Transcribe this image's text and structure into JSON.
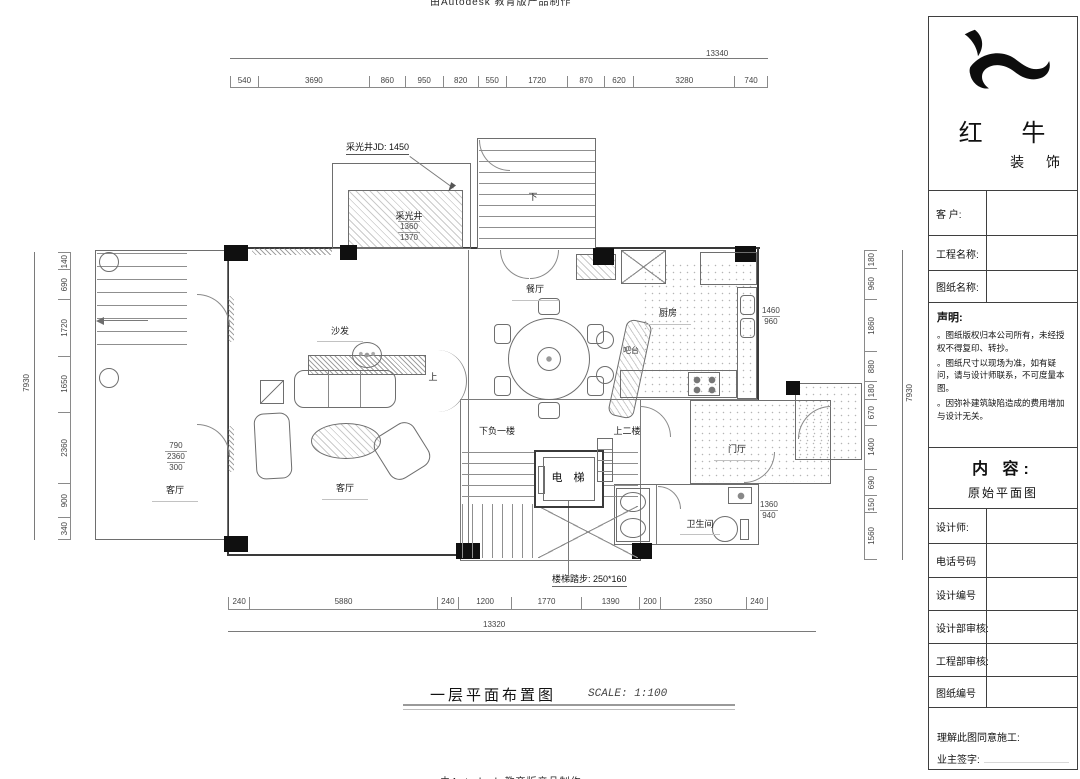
{
  "watermark": {
    "top": "由Autodesk 教育版产品制作",
    "bottom": "由Autodesk 教育版产品制作"
  },
  "title_block": {
    "brand": {
      "name": "红 牛",
      "suffix": "装 饰"
    },
    "customer_label": "客  户:",
    "project_label": "工程名称:",
    "drawing_label": "图纸名称:",
    "statement": {
      "heading": "声明:",
      "items": [
        "。图纸版权归本公司所有，未经授权不得复印、转抄。",
        "。图纸尺寸以现场为准，如有疑问，请与设计师联系，不可度量本图。",
        "。因弥补建筑缺陷造成的费用增加与设计无关。"
      ]
    },
    "content": {
      "heading": "内 容:",
      "value": "原始平面图"
    },
    "designer_label": "设计师:",
    "phone_label": "电话号码",
    "design_no_label": "设计编号",
    "design_review_label": "设计部审核:",
    "eng_review_label": "工程部审核:",
    "drawing_no_label": "图纸编号",
    "agree_label": "理解此图同意施工:",
    "sign_label": "业主签字:"
  },
  "plan": {
    "labels": {
      "dining": "餐厅",
      "kitchen": "厨房",
      "bar": "吧台",
      "sofa": "沙发",
      "living": "客厅",
      "living_left": "客厅",
      "foyer": "门厅",
      "bath": "卫生间",
      "elevator": "电 梯",
      "light_well": "采光井",
      "light_well_jd": "采光井JD: 1450",
      "down_b1": "下负一楼",
      "up_2f": "上二楼",
      "stair_note": "楼梯踏步: 250*160",
      "down": "下",
      "up": "上"
    },
    "dims": {
      "top": {
        "total": "13340",
        "segments": [
          "540",
          "3690",
          "860",
          "950",
          "820",
          "550",
          "1720",
          "870",
          "620",
          "3280",
          "740"
        ]
      },
      "bottom": {
        "total": "13320",
        "segments": [
          "240",
          "5880",
          "240",
          "1200",
          "1770",
          "1390",
          "200",
          "2350",
          "240"
        ]
      },
      "left": {
        "total": "7930",
        "segments": [
          "140",
          "690",
          "1720",
          "1650",
          "2360",
          "900",
          "340"
        ]
      },
      "right": {
        "total": "7930",
        "segments": [
          "180",
          "960",
          "1860",
          "880",
          "180",
          "670",
          "1400",
          "690",
          "150",
          "1560"
        ]
      },
      "stacks": {
        "light_well": [
          "1360",
          "1370"
        ],
        "living_left": [
          "790",
          "2360",
          "300"
        ],
        "kitchen": [
          "1460",
          "960"
        ],
        "bath": [
          "1360",
          "940"
        ]
      }
    },
    "footer": {
      "title": "一层平面布置图",
      "scale": "SCALE: 1:100"
    }
  }
}
